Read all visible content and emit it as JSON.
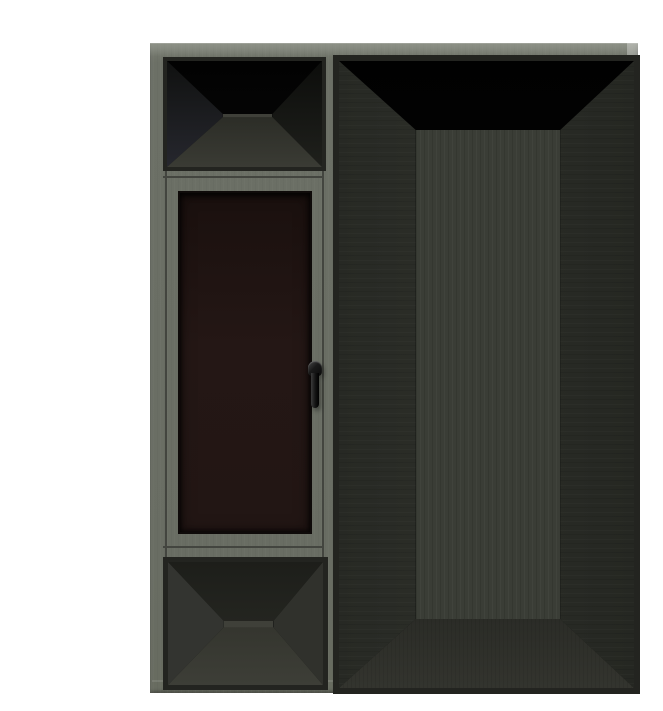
{
  "scene": {
    "description": "3D product render on a white background: gray-green aluminum window/door frame assembly. Left column holds an open transom vent at top, a dark-glazed casement window with a black handle in the middle, and an open bottom panel. The right side is a tall empty door opening showing a dark box interior in perspective.",
    "background": "#ffffff"
  },
  "parts": {
    "assembly": "aluminum window-door frame assembly",
    "transom": "open transom opening",
    "window": "dark glazed casement window",
    "handle": "black window handle",
    "bottom_panel": "open bottom panel opening",
    "door": "tall open door frame opening"
  },
  "colors": {
    "page-bg": "#ffffff",
    "frame-gray": "#6c7066",
    "frame-gray-light": "#969a90",
    "frame-gray-dark": "#5d6157",
    "bevel-dark": "#232420",
    "groove": "#43453f",
    "interior-black": "#070707",
    "wall-dark": "#26272e",
    "wall-mid": "#33352f",
    "wall-mid-right": "#2f312b",
    "back-wall": "#3a3d36",
    "floor-light": "#3a3b34",
    "floor-door": "#33342e",
    "panel-ceiling": "#2b2c26",
    "panel-floor": "#3d3e37",
    "panel-back": "#3f4039",
    "glass-dark-brown": "#241715",
    "glass-edge": "#0e0a09",
    "handle-black": "#0a0a0a",
    "handle-highlight": "#4a4a4a"
  }
}
